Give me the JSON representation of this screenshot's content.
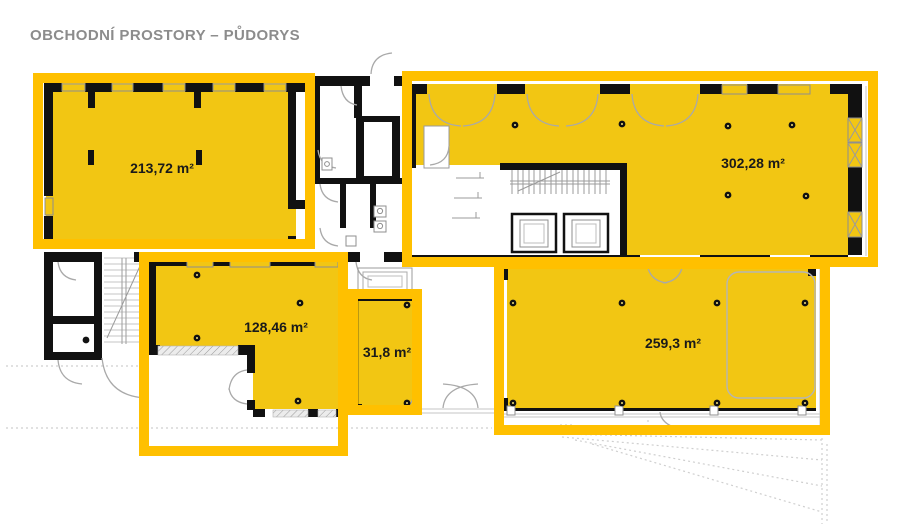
{
  "page": {
    "title": "OBCHODNÍ PROSTORY – PŮDORYS"
  },
  "floor_plan": {
    "description_labels": {
      "unit_count": "5"
    },
    "units": [
      {
        "name": "unit-top-left",
        "area_label": "213,72 m²"
      },
      {
        "name": "unit-top-right",
        "area_label": "302,28 m²"
      },
      {
        "name": "unit-mid-left",
        "area_label": "128,46 m²"
      },
      {
        "name": "unit-small-middle",
        "area_label": "31,8 m²"
      },
      {
        "name": "unit-bottom-right",
        "area_label": "259,3 m²"
      }
    ]
  },
  "colors": {
    "highlight_fill": "#F2C613",
    "highlight_border": "#FFC000",
    "wall": "#111111",
    "title_gray": "#8c8c8c",
    "label_black": "#1a1a1a"
  }
}
